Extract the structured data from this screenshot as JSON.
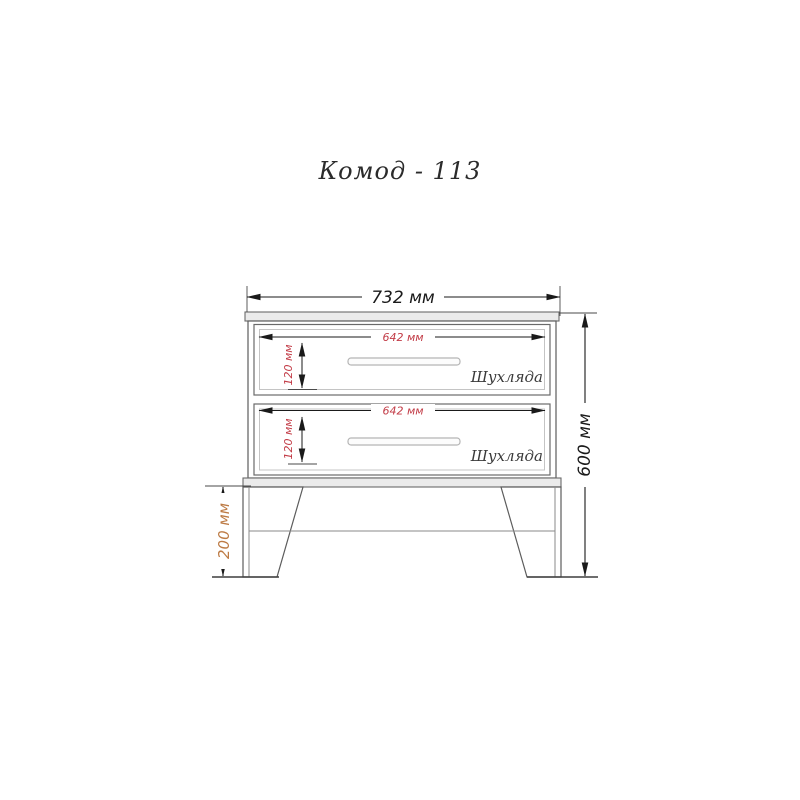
{
  "title": "Комод - 113",
  "colors": {
    "line": "#4a4a4a",
    "dim": "#1a1a1a",
    "red": "#c23b46",
    "brown": "#bd7b45",
    "label": "#3a3a3a",
    "slab_fill": "#ebebeb",
    "inner_border": "#c4c4c4"
  },
  "dimensions": {
    "overall_width": "732 мм",
    "overall_height": "600 мм",
    "leg_height": "200 мм"
  },
  "drawers": [
    {
      "label": "Шухляда",
      "width": "642 мм",
      "height": "120 мм"
    },
    {
      "label": "Шухляда",
      "width": "642 мм",
      "height": "120 мм"
    }
  ]
}
